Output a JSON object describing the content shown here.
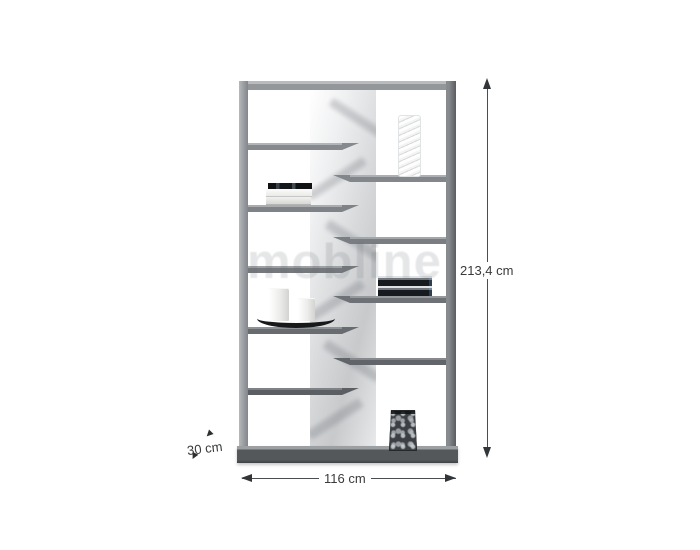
{
  "page": {
    "background": "#ffffff",
    "description": "furniture product photo with dimension arrows"
  },
  "watermark": {
    "text": "mobline"
  },
  "dimension_labels": {
    "height": "213,4 cm",
    "width": "116 cm",
    "depth": "30 cm"
  },
  "furniture": {
    "type": "open zigzag bookcase",
    "frame_color": "#8b8e91",
    "accent_panel_color": "#dfe1e2",
    "shelves_left": 5,
    "shelves_right": 4
  },
  "decor_items": [
    "spiral-ornament",
    "book-stack-left",
    "book-stack-right",
    "candles-on-tray",
    "decor-vase"
  ]
}
